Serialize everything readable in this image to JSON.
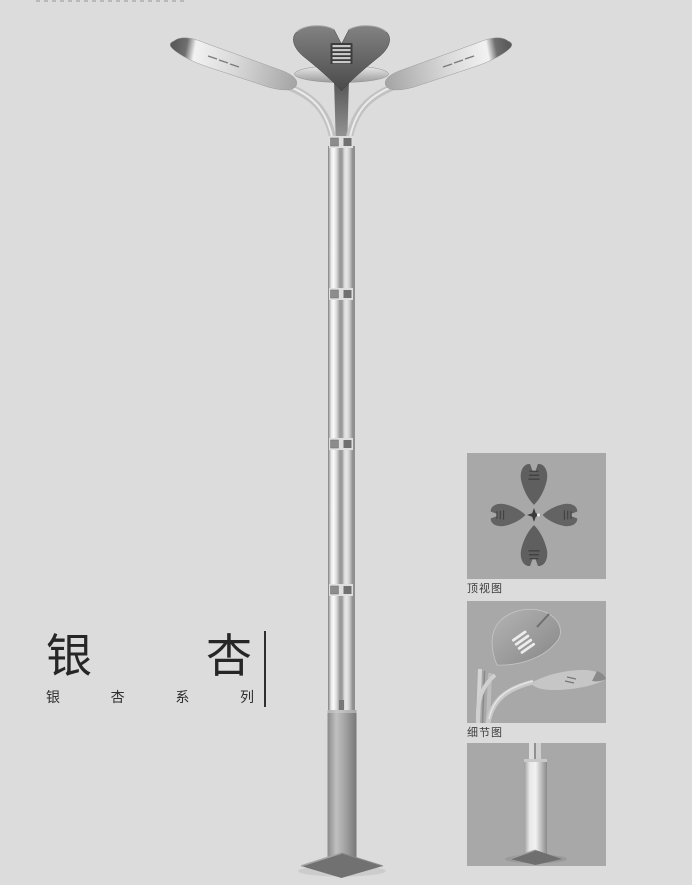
{
  "page": {
    "background_color": "#dcdcdd"
  },
  "title_block": {
    "main_text": "银杏",
    "main_chars": [
      "银",
      "杏"
    ],
    "subtitle_text": "银杏系列",
    "subtitle_chars": [
      "银",
      "杏",
      "系",
      "列"
    ]
  },
  "detail_panels": [
    {
      "id": "top-view",
      "label": "顶视图",
      "graphic": "ginkgo-lamp-top-view"
    },
    {
      "id": "detail-view",
      "label": "细节图",
      "graphic": "ginkgo-leaf-lamp-head-closeup"
    },
    {
      "id": "base-view",
      "label": "",
      "graphic": "pole-base-view"
    }
  ],
  "illustration": {
    "graphic": "double-arm-ginkgo-street-lamp-render"
  },
  "colors": {
    "page_bg": "#dcdcdd",
    "panel_bg": "#a8a8a8",
    "text": "#262626",
    "lamp_head_dark": "#4e4e4e",
    "metal_highlight": "#f4f4f4",
    "metal_mid": "#c6c6c6",
    "metal_shadow": "#8b8b8b",
    "base_gray": "#9b9b9b"
  }
}
